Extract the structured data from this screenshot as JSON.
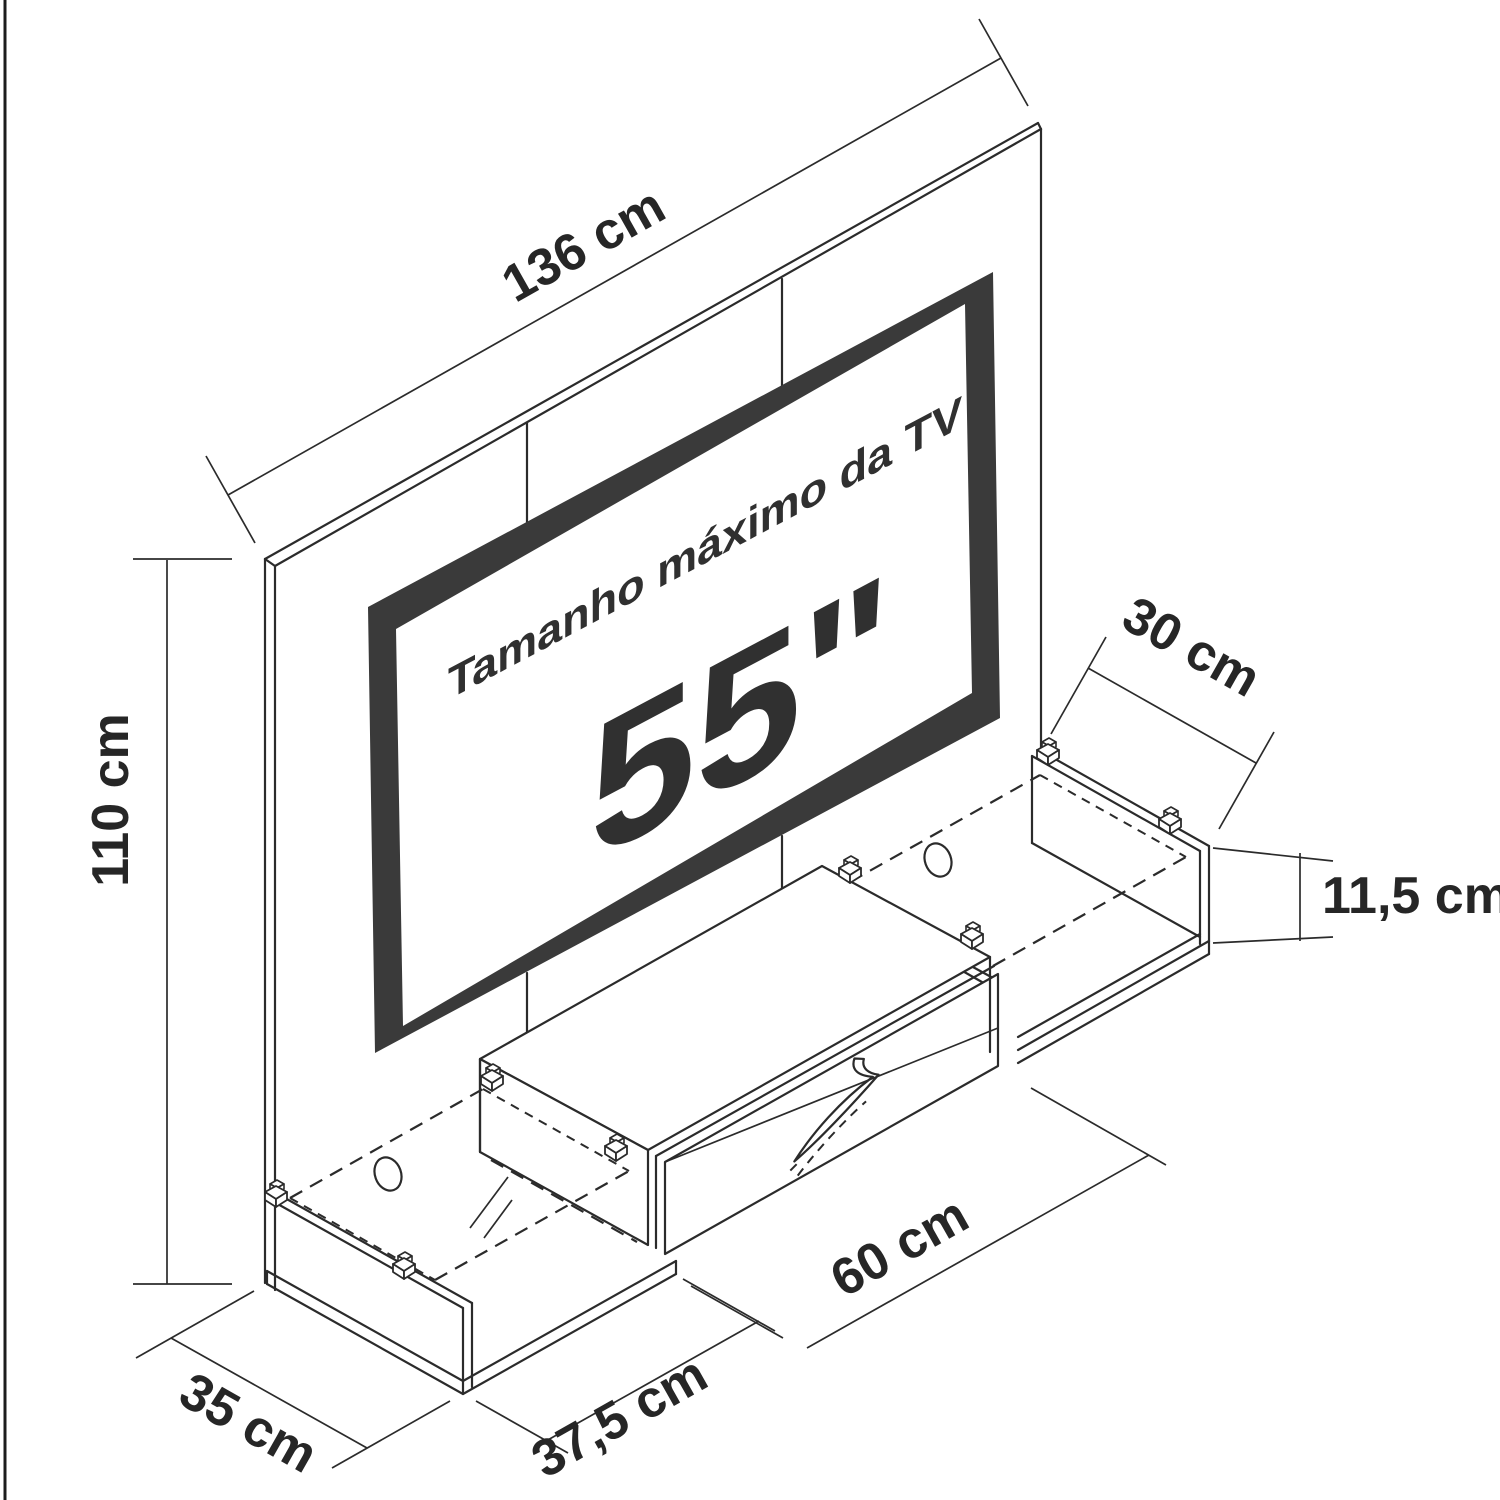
{
  "diagram": {
    "type": "furniture-technical-drawing",
    "tv_screen": {
      "line1": "Tamanho máximo da TV",
      "size": "55\"",
      "frame_color": "#3a3a3a"
    },
    "dimensions": {
      "panel_width": {
        "label": "136 cm",
        "value": 136,
        "unit": "cm"
      },
      "panel_height": {
        "label": "110 cm",
        "value": 110,
        "unit": "cm"
      },
      "right_shelf_depth": {
        "label": "30 cm",
        "value": 30,
        "unit": "cm"
      },
      "shelf_height": {
        "label": "11,5 cm",
        "value": 11.5,
        "unit": "cm"
      },
      "drawer_width": {
        "label": "60 cm",
        "value": 60,
        "unit": "cm"
      },
      "left_shelf_width": {
        "label": "37,5 cm",
        "value": 37.5,
        "unit": "cm"
      },
      "left_shelf_depth": {
        "label": "35 cm",
        "value": 35,
        "unit": "cm"
      }
    },
    "colors": {
      "background": "#ffffff",
      "line": "#2b2b2b",
      "tv_frame": "#3a3a3a",
      "text": "#262626"
    }
  }
}
